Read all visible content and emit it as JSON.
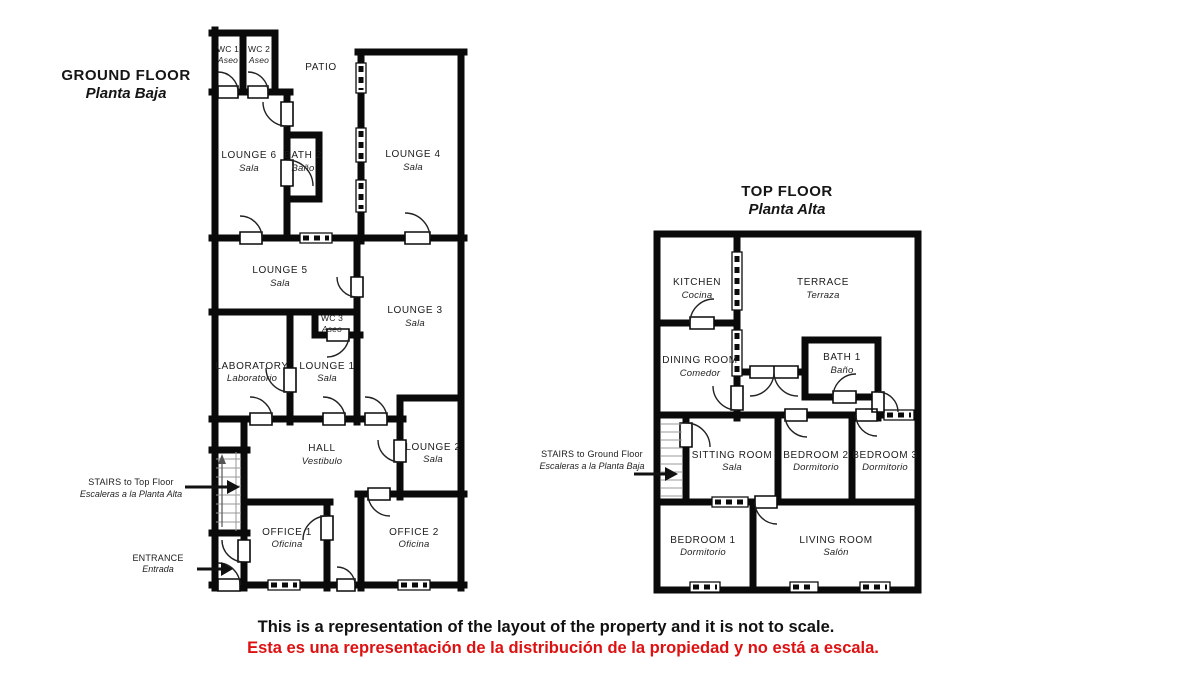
{
  "ground_floor": {
    "title": "GROUND FLOOR",
    "subtitle": "Planta Baja",
    "patio_label": "PATIO",
    "rooms": {
      "wc1": {
        "en": "WC 1",
        "es": "Aseo"
      },
      "wc2": {
        "en": "WC 2",
        "es": "Aseo"
      },
      "lounge6": {
        "en": "LOUNGE 6",
        "es": "Sala"
      },
      "bath2": {
        "en": "BATH 2",
        "es": "Baño"
      },
      "lounge4": {
        "en": "LOUNGE 4",
        "es": "Sala"
      },
      "lounge5": {
        "en": "LOUNGE 5",
        "es": "Sala"
      },
      "wc3": {
        "en": "WC 3",
        "es": "Aseo"
      },
      "lounge3": {
        "en": "LOUNGE 3",
        "es": "Sala"
      },
      "laboratory": {
        "en": "LABORATORY",
        "es": "Laboratorio"
      },
      "lounge1": {
        "en": "LOUNGE 1",
        "es": "Sala"
      },
      "hall": {
        "en": "HALL",
        "es": "Vestibulo"
      },
      "lounge2": {
        "en": "LOUNGE 2",
        "es": "Sala"
      },
      "office1": {
        "en": "OFFICE 1",
        "es": "Oficina"
      },
      "office2": {
        "en": "OFFICE 2",
        "es": "Oficina"
      }
    },
    "annotations": {
      "stairs": {
        "en": "STAIRS to Top Floor",
        "es": "Escaleras a la Planta Alta"
      },
      "entrance": {
        "en": "ENTRANCE",
        "es": "Entrada"
      }
    }
  },
  "top_floor": {
    "title": "TOP FLOOR",
    "subtitle": "Planta Alta",
    "rooms": {
      "kitchen": {
        "en": "KITCHEN",
        "es": "Cocina"
      },
      "terrace": {
        "en": "TERRACE",
        "es": "Terraza"
      },
      "dining": {
        "en": "DINING ROOM",
        "es": "Comedor"
      },
      "bath1": {
        "en": "BATH 1",
        "es": "Baño"
      },
      "sitting": {
        "en": "SITTING ROOM",
        "es": "Sala"
      },
      "bedroom2": {
        "en": "BEDROOM 2",
        "es": "Dormitorio"
      },
      "bedroom3": {
        "en": "BEDROOM 3",
        "es": "Dormitorio"
      },
      "bedroom1": {
        "en": "BEDROOM 1",
        "es": "Dormitorio"
      },
      "living": {
        "en": "LIVING ROOM",
        "es": "Salón"
      }
    },
    "annotations": {
      "stairs": {
        "en": "STAIRS to Ground Floor",
        "es": "Escaleras a la Planta Baja"
      }
    }
  },
  "disclaimer": {
    "en": "This is a representation of the layout of the property and it is not to scale.",
    "es": "Esta es una representación de la distribución de la propiedad y no está a escala."
  },
  "colors": {
    "wall": "#0a0a0a",
    "disclaimer_red": "#dd1111"
  }
}
